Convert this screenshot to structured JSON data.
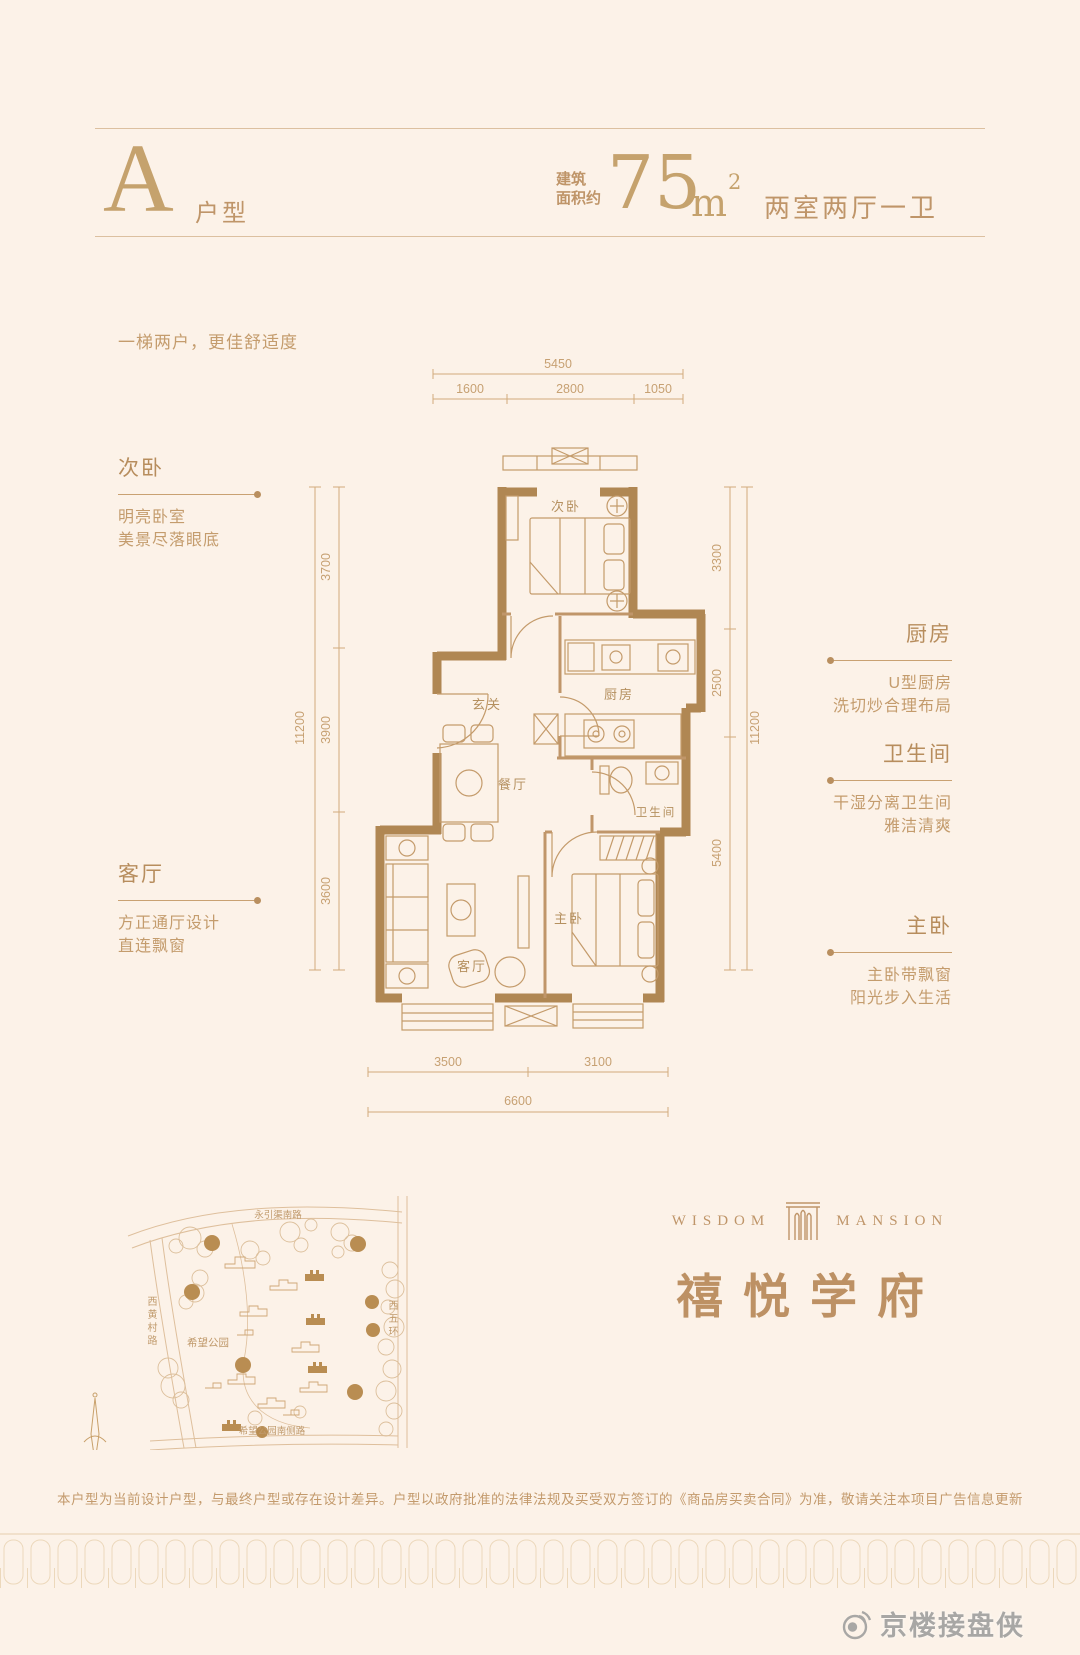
{
  "colors": {
    "background": "#fcf2e8",
    "accent_gold": "#bf9569",
    "wall_tan": "#b08753",
    "light_line": "#dcc0a0",
    "watermark_gray": "#9a9a9a"
  },
  "header": {
    "unit_letter": "A",
    "unit_label": "户型",
    "area_prefix_line1": "建筑",
    "area_prefix_line2": "面积约",
    "area_value": "75",
    "area_unit": "m",
    "area_superscript": "2",
    "rooms_summary": "两室两厅一卫"
  },
  "tagline": "一梯两户，更佳舒适度",
  "callouts": {
    "left": [
      {
        "title": "次卧",
        "line1": "明亮卧室",
        "line2": "美景尽落眼底"
      },
      {
        "title": "客厅",
        "line1": "方正通厅设计",
        "line2": "直连飘窗"
      }
    ],
    "right": [
      {
        "title": "厨房",
        "line1": "U型厨房",
        "line2": "洗切炒合理布局"
      },
      {
        "title": "卫生间",
        "line1": "干湿分离卫生间",
        "line2": "雅洁清爽"
      },
      {
        "title": "主卧",
        "line1": "主卧带飘窗",
        "line2": "阳光步入生活"
      }
    ]
  },
  "floor_plan": {
    "rooms": {
      "secondary_bedroom": "次卧",
      "entry": "玄关",
      "kitchen": "厨房",
      "dining": "餐厅",
      "bathroom": "卫生间",
      "master_bedroom": "主卧",
      "living_room": "客厅"
    },
    "dimensions": {
      "top_total": "5450",
      "top_seg1": "1600",
      "top_seg2": "2800",
      "top_seg3": "1050",
      "left_total": "11200",
      "left_seg1": "3700",
      "left_seg2": "3900",
      "left_seg3": "3600",
      "right_total": "11200",
      "right_seg1": "3300",
      "right_seg2": "2500",
      "right_seg3": "5400",
      "bottom_seg1": "3500",
      "bottom_seg2": "3100",
      "bottom_total": "6600"
    }
  },
  "site_map": {
    "road_top": "永引渠南路",
    "road_left": "西黄村路",
    "road_right": "西五环",
    "road_bottom": "希望公园南侧路",
    "park": "希望公园"
  },
  "brand": {
    "logo_word_left": "WISDOM",
    "logo_word_right": "MANSION",
    "name": "禧悦学府"
  },
  "disclaimer": "本户型为当前设计户型，与最终户型或存在设计差异。户型以政府批准的法律法规及买受双方签订的《商品房买卖合同》为准，敬请关注本项目广告信息更新",
  "watermark": "京楼接盘侠"
}
